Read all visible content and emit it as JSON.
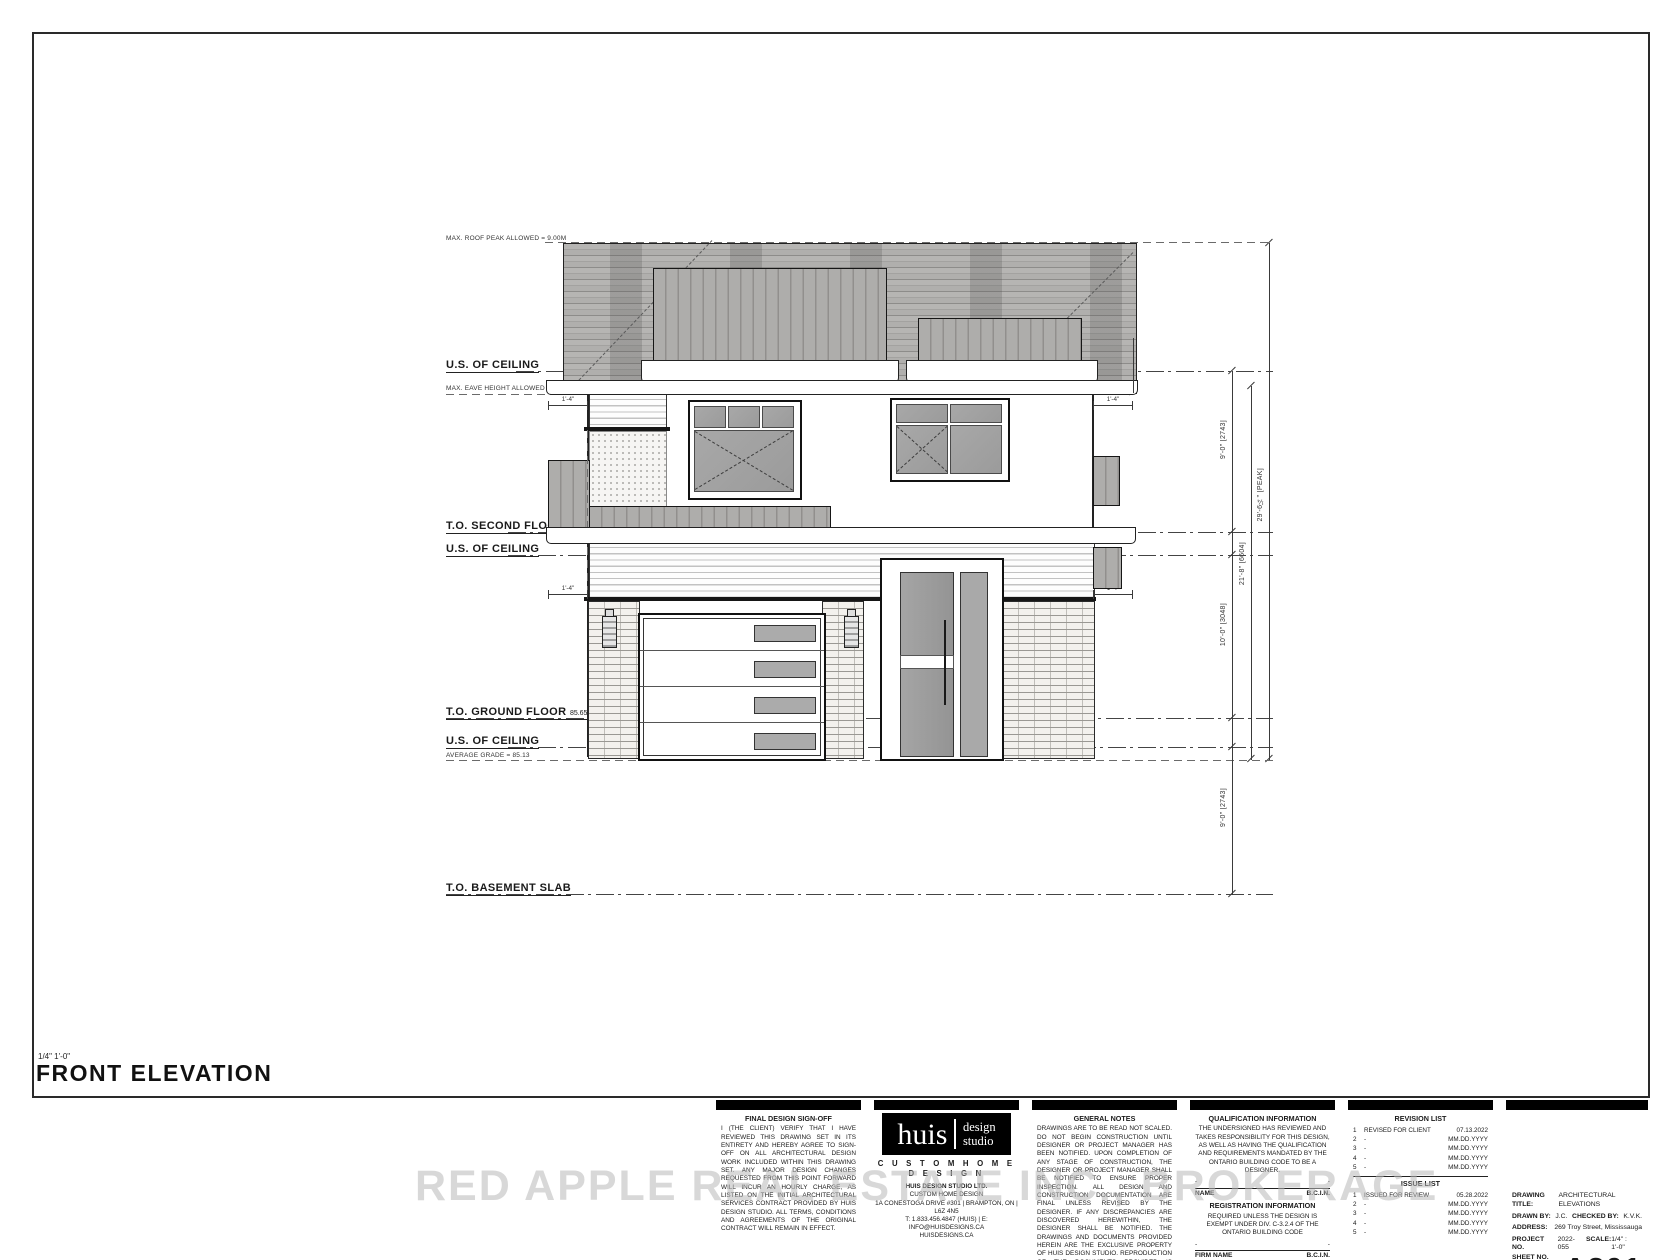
{
  "colors": {
    "paper": "#ffffff",
    "ink": "#1a1a1a",
    "roof_gray": "#b0afad",
    "glass_gray": "#a2a2a2",
    "watermark_gray": "#b9b9b9",
    "bar_black": "#000000"
  },
  "watermark": "RED APPLE REAL ESTATE INC., BROKERAGE",
  "elevation": {
    "title": "FRONT ELEVATION",
    "scale_note": "1/4\" 1'-0\"",
    "levels": {
      "max_roof_peak": "MAX. ROOF PEAK ALLOWED = 9.00M",
      "us_ceiling": "U.S. OF CEILING",
      "max_eave": "MAX. EAVE HEIGHT ALLOWED = 6.40M",
      "to_second": "T.O. SECOND FLOOR",
      "to_ground": "T.O. GROUND FLOOR",
      "ffl": "85.65 FFL",
      "avg_grade": "AVERAGE GRADE = 85.13",
      "to_basement": "T.O. BASEMENT SLAB"
    },
    "dimensions": {
      "soffit": "8\" (SOFFIT)",
      "eave_offset": "1'-4\"",
      "second_storey": "9'-0\" [2743]",
      "ground_storey": "10'-0\" [3048]",
      "basement_storey": "9'-0\" [2743]",
      "eave_height": "21'-8\" [6604]",
      "peak_height": "29'-6¼\" [PEAK]"
    }
  },
  "blocks": {
    "signoff": {
      "title": "FINAL DESIGN SIGN-OFF",
      "body": "I (THE CLIENT) VERIFY THAT I HAVE REVIEWED THIS DRAWING SET IN ITS ENTIRETY AND HEREBY AGREE TO SIGN-OFF ON ALL ARCHITECTURAL DESIGN WORK INCLUDED WITHIN THIS DRAWING SET.  ANY MAJOR DESIGN CHANGES REQUESTED FROM THIS POINT FORWARD WILL INCUR AN HOURLY CHARGE, AS LISTED ON THE INITIAL ARCHITECTURAL SERVICES CONTRACT PROVIDED BY HUIS DESIGN STUDIO.  ALL TERMS, CONDITIONS AND AGREEMENTS OF THE ORIGINAL CONTRACT WILL REMAIN IN EFFECT.",
      "client_initials_label": "CLIENT INITIALS:",
      "huis_initials_label": "HUIS INITIALS:"
    },
    "studio": {
      "logo_main": "huis",
      "logo_sub1": "design",
      "logo_sub2": "studio",
      "tagline": "C U S T O M   H O M E   D E S I G N",
      "lines": [
        "HUIS DESIGN STUDIO LTD.",
        "CUSTOM HOME DESIGN",
        "1A CONESTOGA DRIVE #301 | BRAMPTON, ON | L6Z 4N5",
        "T: 1.833.456.4847 (HUIS) | E: INFO@HUISDESIGNS.CA",
        "HUISDESIGNS.CA"
      ]
    },
    "notes": {
      "title": "GENERAL NOTES",
      "body": "DRAWINGS ARE TO BE READ NOT SCALED. DO NOT BEGIN CONSTRUCTION UNTIL DESIGNER OR PROJECT MANAGER HAS BEEN NOTIFIED. UPON COMPLETION OF ANY STAGE OF CONSTRUCTION, THE DESIGNER OR PROJECT MANAGER SHALL BE NOTIFIED TO ENSURE PROPER INSPECTION. ALL DESIGN AND CONSTRUCTION DOCUMENTATION ARE FINAL UNLESS REVISED BY THE DESIGNER. IF ANY DISCREPANCIES ARE DISCOVERED HEREWITHIN, THE DESIGNER SHALL BE NOTIFIED. THE DRAWINGS AND DOCUMENTS PROVIDED HEREIN ARE THE EXCLUSIVE PROPERTY OF HUIS DESIGN STUDIO. REPRODUCTION OF THE DOCUMENTS PROVIDED IS PROHIBITED WITHOUT THE CONSENT OF THE DESIGNER."
    },
    "qualification": {
      "title": "QUALIFICATION INFORMATION",
      "body": "THE UNDERSIGNED HAS REVIEWED AND TAKES RESPONSIBILITY FOR THIS DESIGN, AS WELL AS HAVING THE QUALIFICATION AND REQUIREMENTS MANDATED BY THE ONTARIO BUILDING CODE TO BE A DESIGNER.",
      "placeholder": "-",
      "name_label": "NAME",
      "bcin_label": "B.C.I.N.",
      "title2": "REGISTRATION INFORMATION",
      "body2": "REQUIRED UNLESS THE DESIGN IS EXEMPT UNDER DIV. C-3.2.4 OF THE ONTARIO BUILDING CODE",
      "firm_label": "FIRM NAME"
    },
    "revisions": {
      "title": "REVISION LIST",
      "rows": [
        {
          "no": "1",
          "desc": "REVISED FOR CLIENT",
          "date": "07.13.2022"
        },
        {
          "no": "2",
          "desc": "-",
          "date": "MM.DD.YYYY"
        },
        {
          "no": "3",
          "desc": "-",
          "date": "MM.DD.YYYY"
        },
        {
          "no": "4",
          "desc": "-",
          "date": "MM.DD.YYYY"
        },
        {
          "no": "5",
          "desc": "-",
          "date": "MM.DD.YYYY"
        }
      ],
      "issue_title": "ISSUE LIST",
      "issue_rows": [
        {
          "no": "1",
          "desc": "ISSUED FOR REVIEW",
          "date": "05.28.2022"
        },
        {
          "no": "2",
          "desc": "-",
          "date": "MM.DD.YYYY"
        },
        {
          "no": "3",
          "desc": "-",
          "date": "MM.DD.YYYY"
        },
        {
          "no": "4",
          "desc": "-",
          "date": "MM.DD.YYYY"
        },
        {
          "no": "5",
          "desc": "-",
          "date": "MM.DD.YYYY"
        }
      ]
    },
    "titleblock": {
      "drawing_title_label": "DRAWING TITLE:",
      "drawing_title": "ARCHITECTURAL ELEVATIONS",
      "drawn_by_label": "DRAWN BY:",
      "drawn_by": "J.C.",
      "checked_by_label": "CHECKED BY:",
      "checked_by": "K.V.K.",
      "address_label": "ADDRESS:",
      "address": "269 Troy Street, Mississauga",
      "project_no_label": "PROJECT NO.",
      "project_no": "2022-055",
      "scale_label": "SCALE:",
      "scale": "1/4\" : 1'-0\"",
      "sheet_no_label": "SHEET NO.",
      "sheet_no": "A201"
    }
  }
}
